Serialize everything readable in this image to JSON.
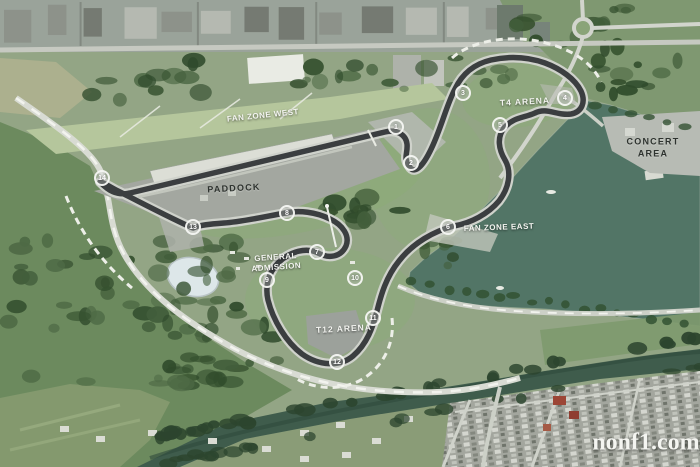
{
  "map": {
    "description_labels_present": true
  },
  "colors": {
    "grass": "#93a585",
    "infield_green": "#8bac77",
    "track": "#3b3e40",
    "track_edge": "#cfd2cb",
    "lake": "#527566",
    "river": "#3f5c4c",
    "road": "#d9dcd4",
    "urban": "#9aa39a",
    "trees": "#43603e",
    "label_light": "#f4f5f1",
    "label_dark": "#2e332f"
  },
  "labels": [
    {
      "id": "fan-zone-west",
      "text": "FAN ZONE WEST",
      "x": 263,
      "y": 116,
      "size": 8,
      "rotation": -6,
      "color": "light",
      "tracking": 0.5
    },
    {
      "id": "paddock",
      "text": "PADDOCK",
      "x": 234,
      "y": 189,
      "size": 9,
      "rotation": -3,
      "color": "dark",
      "tracking": 1.2
    },
    {
      "id": "t4-arena",
      "text": "T4 ARENA",
      "x": 525,
      "y": 102,
      "size": 8.5,
      "rotation": -3,
      "color": "light",
      "tracking": 1
    },
    {
      "id": "concert-area",
      "text": "CONCERT\nAREA",
      "x": 653,
      "y": 148,
      "size": 9,
      "rotation": 0,
      "color": "dark",
      "tracking": 1.2
    },
    {
      "id": "fan-zone-east",
      "text": "FAN ZONE EAST",
      "x": 499,
      "y": 228,
      "size": 8,
      "rotation": -2,
      "color": "light",
      "tracking": 0.5
    },
    {
      "id": "general-admission",
      "text": "GENERAL\nADMISSION",
      "x": 276,
      "y": 263,
      "size": 8,
      "rotation": -4,
      "color": "light",
      "tracking": 0.5
    },
    {
      "id": "t12-arena",
      "text": "T12 ARENA",
      "x": 344,
      "y": 329,
      "size": 8.5,
      "rotation": -3,
      "color": "light",
      "tracking": 1
    },
    {
      "id": "watermark",
      "text": "nonf1.com",
      "x": 646,
      "y": 443,
      "size": 24,
      "rotation": 0,
      "color": "light",
      "tracking": 0,
      "serif": true
    }
  ],
  "turn_markers": [
    {
      "number": 1,
      "x": 396,
      "y": 127
    },
    {
      "number": 2,
      "x": 411,
      "y": 163
    },
    {
      "number": 3,
      "x": 463,
      "y": 93
    },
    {
      "number": 4,
      "x": 565,
      "y": 98
    },
    {
      "number": 5,
      "x": 500,
      "y": 125
    },
    {
      "number": 6,
      "x": 448,
      "y": 227
    },
    {
      "number": 7,
      "x": 317,
      "y": 252
    },
    {
      "number": 8,
      "x": 287,
      "y": 213
    },
    {
      "number": 9,
      "x": 267,
      "y": 280
    },
    {
      "number": 10,
      "x": 355,
      "y": 278
    },
    {
      "number": 11,
      "x": 373,
      "y": 318
    },
    {
      "number": 12,
      "x": 337,
      "y": 362
    },
    {
      "number": 13,
      "x": 193,
      "y": 227
    },
    {
      "number": 14,
      "x": 102,
      "y": 178
    }
  ]
}
